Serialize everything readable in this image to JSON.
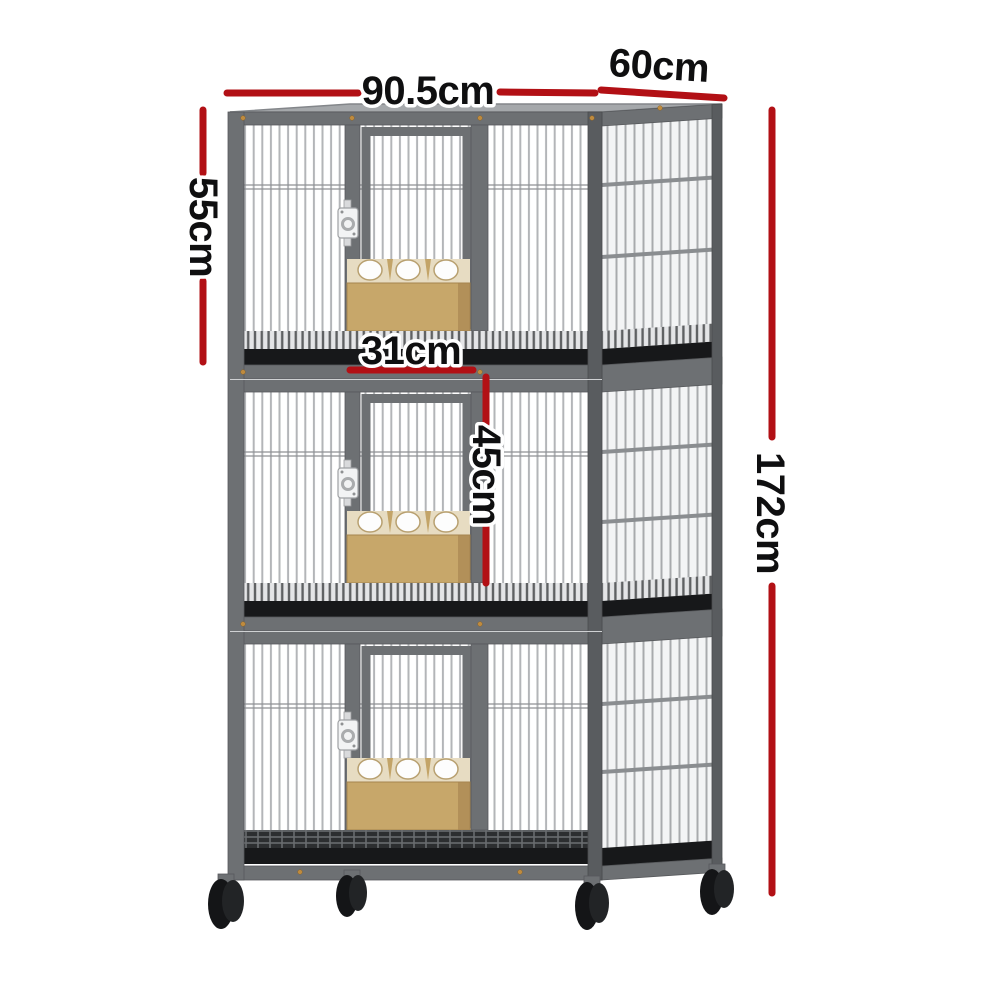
{
  "description": "Three-tier grey wire pet breeding cage on caster wheels with tan feeder boxes, annotated with red dimension lines",
  "dimensions": {
    "width": "90.5cm",
    "depth": "60cm",
    "tier_height": "55cm",
    "door_width": "31cm",
    "door_height": "45cm",
    "total_height": "172cm"
  },
  "colors": {
    "dimension_line": "#b21015",
    "label_text": "#0f0f10",
    "label_outline": "#ffffff",
    "frame": "#6d7073",
    "frame_dark": "#595c5f",
    "bars": "#b3b5b8",
    "tray": "#17181a",
    "feeder": "#c7a76a",
    "feeder_top": "#e7dcc2",
    "wheel": "#141517",
    "background": "#ffffff"
  }
}
